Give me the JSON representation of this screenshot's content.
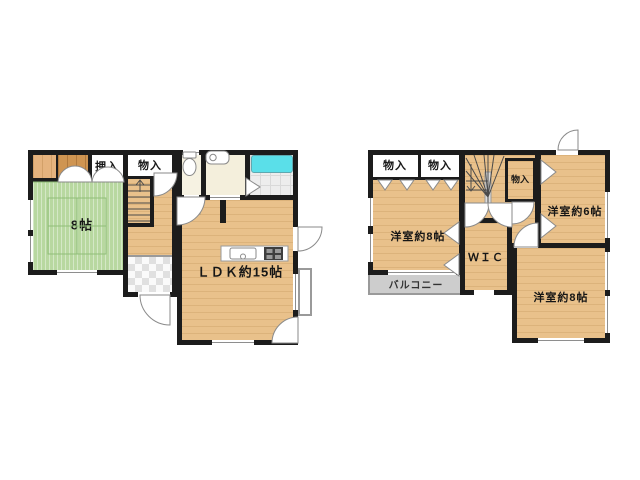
{
  "plan": {
    "floor1": {
      "oshiire": "押入",
      "monoire": "物入",
      "tatami": "8帖",
      "ldk": "ＬＤＫ約15帖"
    },
    "floor2": {
      "storage_a": "物入",
      "storage_b": "物入",
      "storage_c": "物入",
      "bedroom8_top": "洋室約8帖",
      "bedroom6": "洋室約6帖",
      "wic": "ＷＩＣ",
      "balcony": "バルコニー",
      "bedroom8_bottom": "洋室約8帖"
    }
  },
  "colors": {
    "wall": "#1c1c1c",
    "wood_floor": "#e9c18b",
    "tatami_green": "#b8d8a0",
    "bathtub_cyan": "#5adfe9",
    "washroom_cream": "#f4efdc",
    "bath_tile_grey": "#ededed",
    "balcony_grey": "#cdcdcd"
  }
}
